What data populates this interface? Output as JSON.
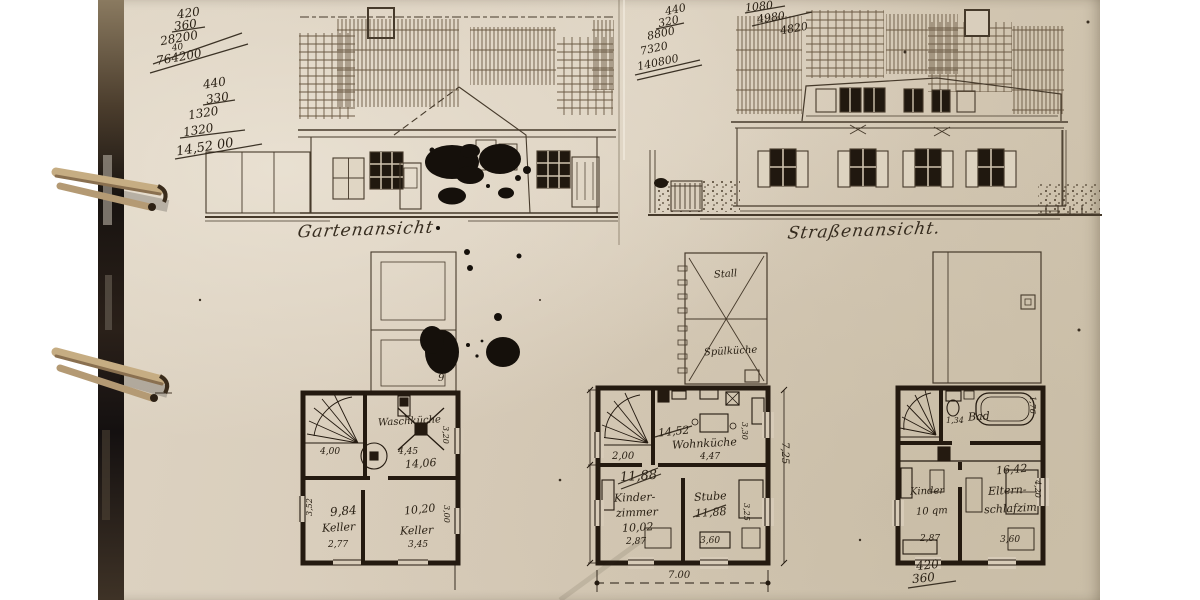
{
  "calculations": {
    "block1": {
      "lines": [
        "420",
        "360",
        "28200",
        "40",
        "764200"
      ]
    },
    "block2": {
      "lines": [
        "440",
        "330",
        "1320",
        "1320",
        "14,52 00"
      ]
    },
    "block3": {
      "lines": [
        "440",
        "320",
        "8800",
        "7320",
        "140800"
      ]
    },
    "block4": {
      "lines": [
        "1080",
        "4980",
        "4820"
      ]
    },
    "block5": {
      "lines": [
        "420",
        "360"
      ]
    }
  },
  "elevations": {
    "garden": {
      "caption": "Gartenansicht"
    },
    "street": {
      "caption": "Straßenansicht."
    }
  },
  "plans": {
    "basement": {
      "waschkueche_name": "Waschküche",
      "waschkueche_dim": "4,45",
      "waschkueche_area": "14,06",
      "waschkueche_width": "3,20",
      "understairs_dim": "4,00",
      "keller_left_area": "9,84",
      "keller_left_name": "Keller",
      "keller_left_dim": "2,77",
      "keller_left_height": "3,52",
      "keller_right_area": "10,20",
      "keller_right_name": "Keller",
      "keller_right_dim": "3,45",
      "keller_right_height": "3,00",
      "annex_note": "9"
    },
    "ground": {
      "stall": "Stall",
      "spuelkueche": "Spülküche",
      "hall_dim": "2,00",
      "wohnkueche_area": "14,52",
      "wohnkueche_name": "Wohnküche",
      "wohnkueche_dim": "4,47",
      "wohnkueche_width": "3,30",
      "crossed_area": "11,88",
      "kinder_name1": "Kinder-",
      "kinder_name2": "zimmer",
      "kinder_area": "10,02",
      "kinder_dim": "2,87",
      "stube_name": "Stube",
      "stube_area": "11,88",
      "stube_dim": "3,60",
      "stube_width": "3,25",
      "total_width": "7.00",
      "total_height": "7,25"
    },
    "upper": {
      "bad_dim": "1,34",
      "bad_name": "Bad",
      "bad_width": "1,76",
      "kinder_name": "Kinder",
      "kinder_area": "10 qm",
      "kinder_dim": "2,87",
      "eltern_area": "16,42",
      "eltern_name1": "Eltern-",
      "eltern_name2": "schlafzim",
      "eltern_dim": "3,60",
      "eltern_width": "4,20"
    }
  }
}
